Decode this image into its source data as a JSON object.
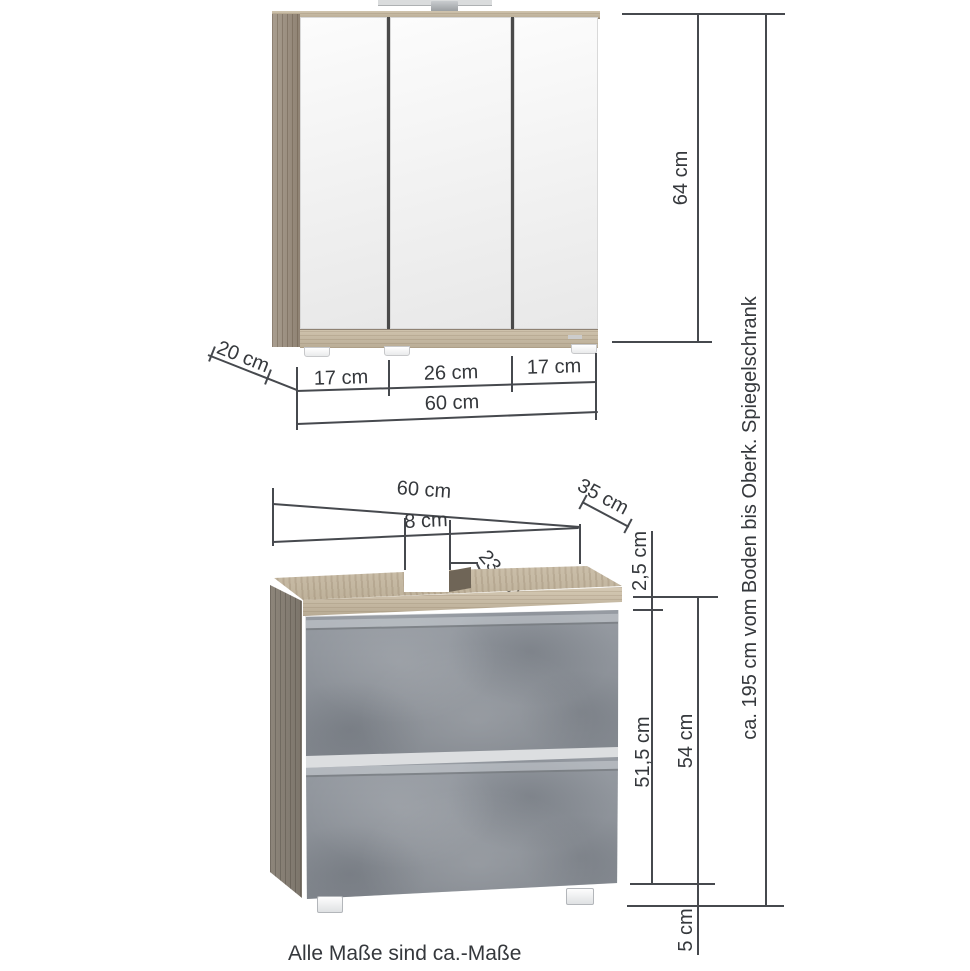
{
  "diagram_title": "Badmoebel Masszeichnung",
  "mirror_cabinet": {
    "height": "64 cm",
    "depth": "20 cm",
    "door_left": "17 cm",
    "door_middle": "26 cm",
    "door_right": "17 cm",
    "width": "60 cm"
  },
  "vanity": {
    "width": "60 cm",
    "depth": "35 cm",
    "cutout_width": "8 cm",
    "cutout_depth": "23 cm",
    "top_thickness": "2,5 cm",
    "body_height": "51,5 cm",
    "total_height": "54 cm",
    "feet_height": "5 cm"
  },
  "overall": {
    "total_height_note": "ca. 195 cm vom Boden bis Oberk. Spiegelschrank"
  },
  "footnote": "Alle Maße sind ca.-Maße",
  "colors": {
    "dimension_line": "#46494e",
    "text": "#35383c",
    "wood": "#c4b7a0",
    "concrete": "#8c9198",
    "mirror": "#f1f1f1"
  }
}
